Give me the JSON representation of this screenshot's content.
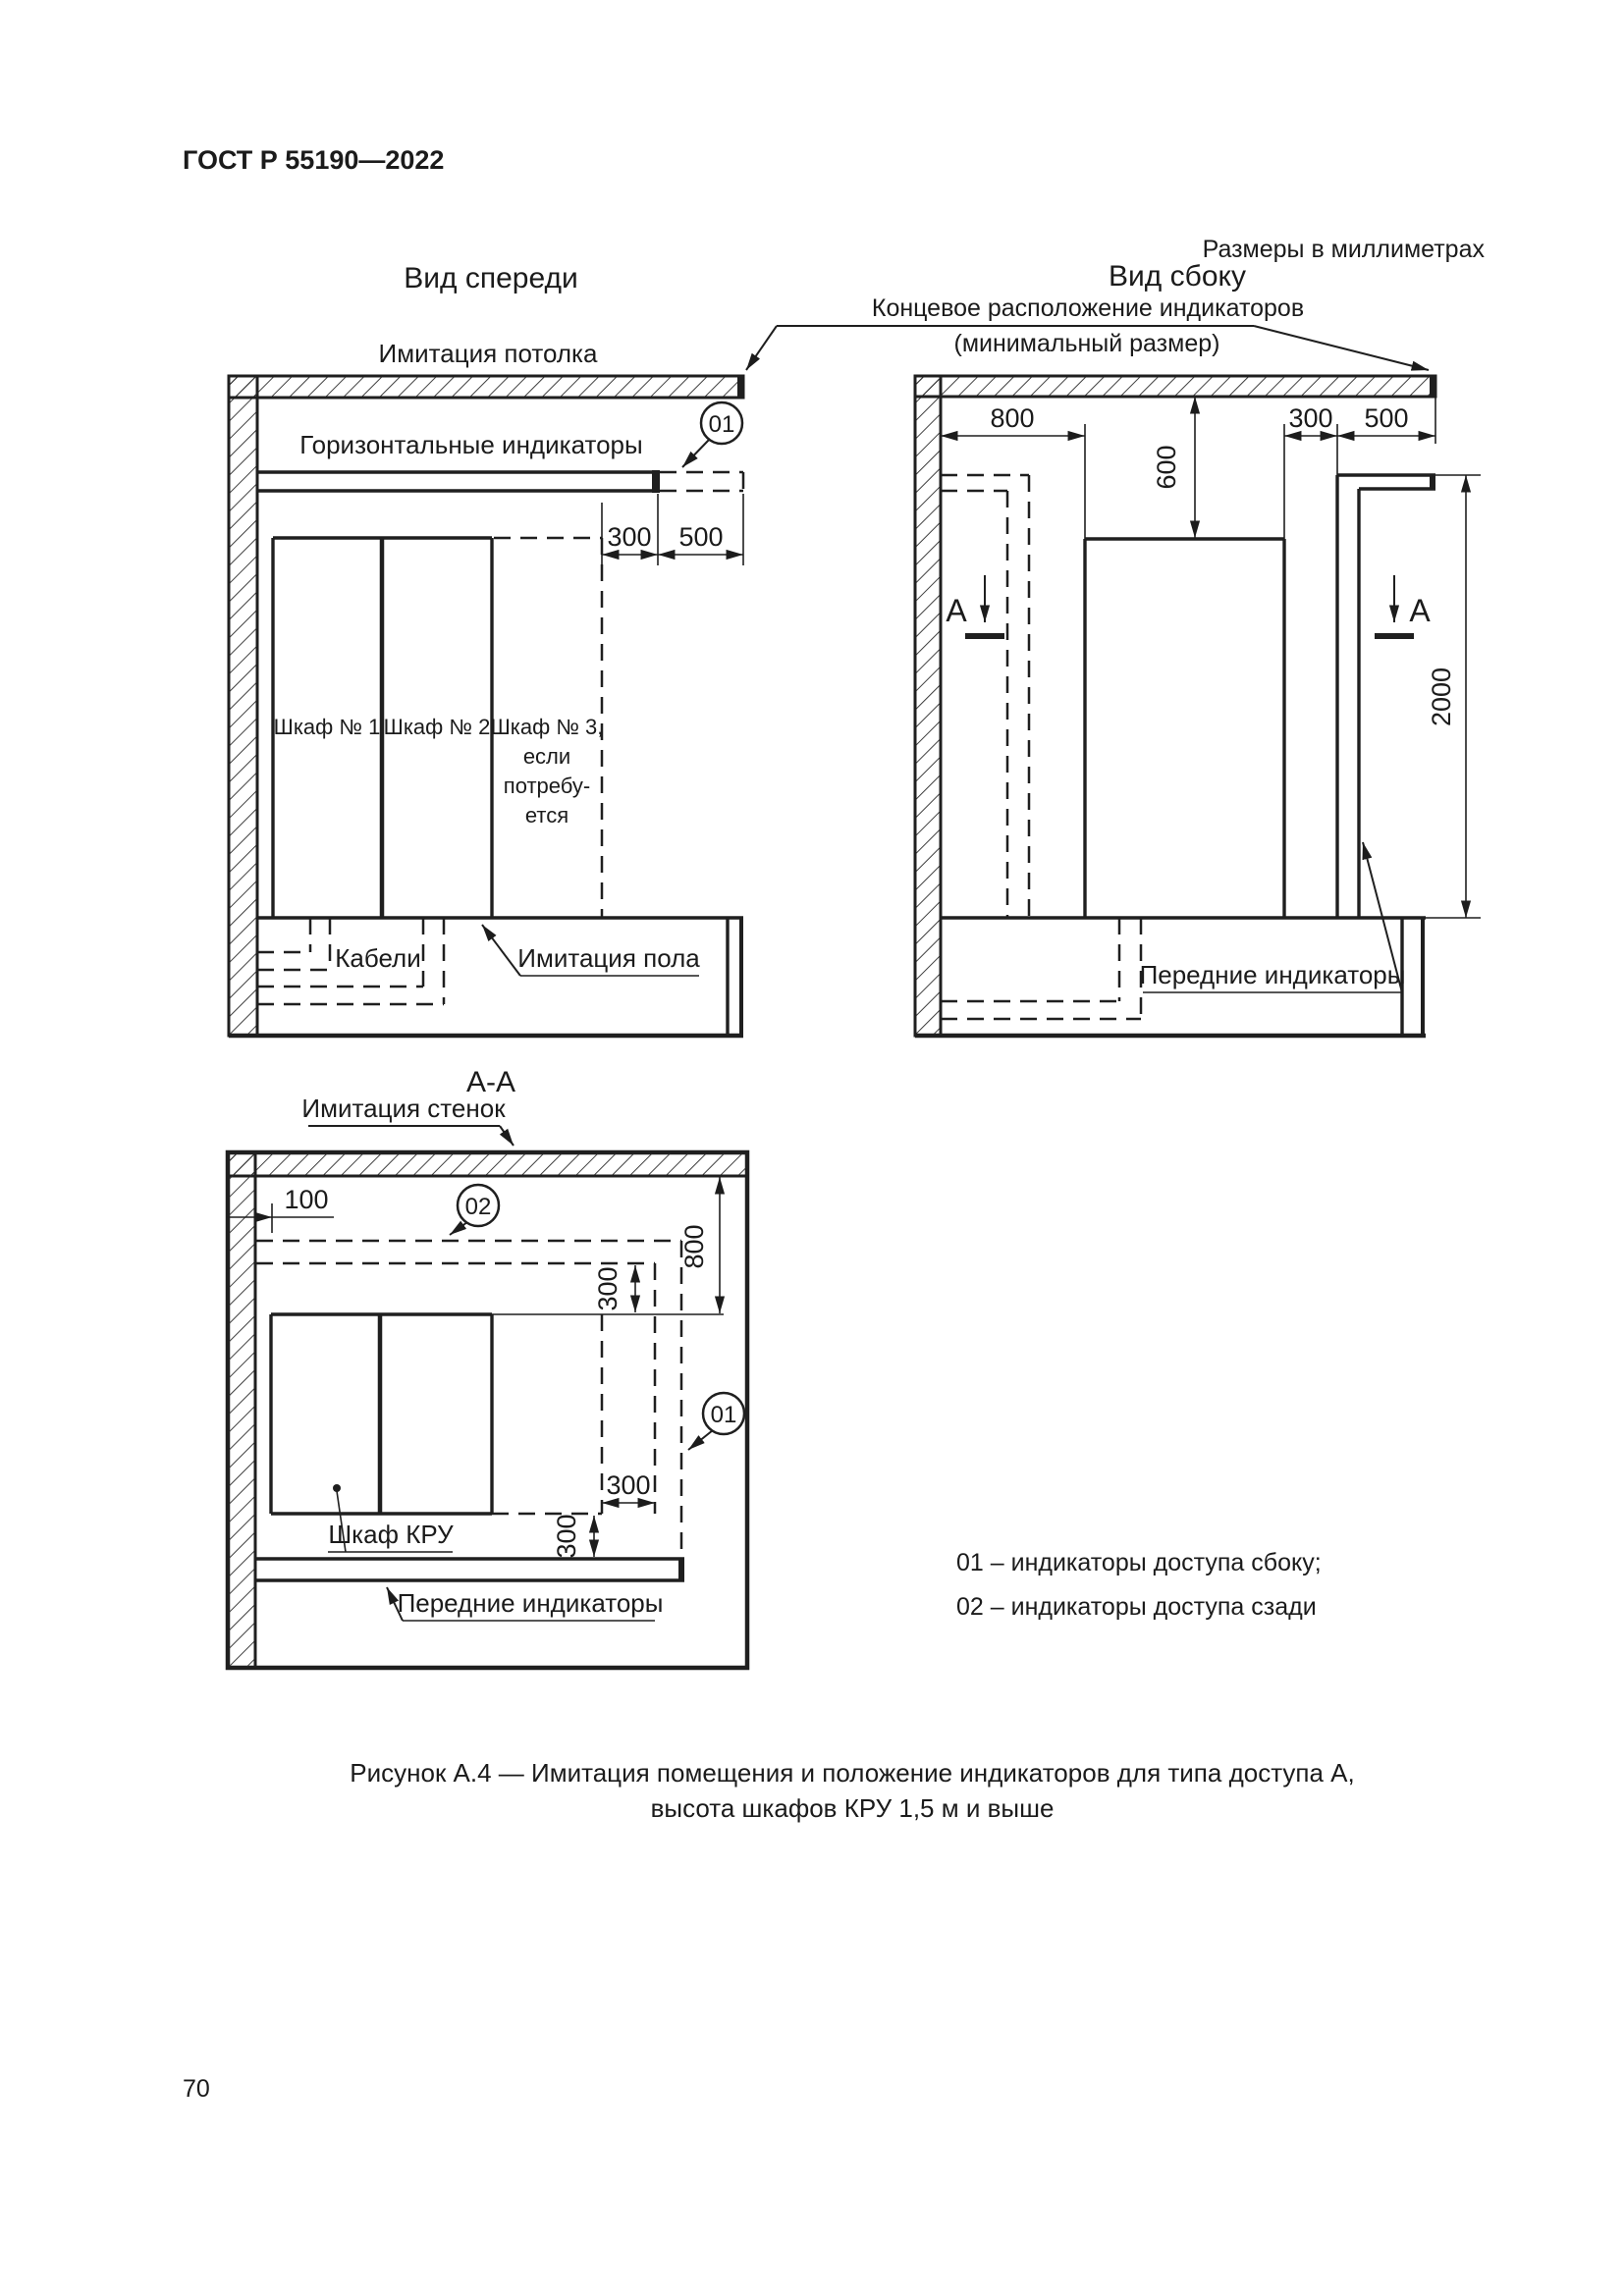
{
  "page": {
    "standard_code": "ГОСТ Р 55190—2022",
    "units_note": "Размеры в миллиметрах",
    "page_number": "70",
    "caption_line1": "Рисунок А.4 — Имитация помещения и положение индикаторов для типа доступа А,",
    "caption_line2": "высота шкафов КРУ 1,5 м и выше"
  },
  "front_view": {
    "title": "Вид спереди",
    "ceiling_label": "Имитация потолка",
    "indicators_label": "Горизонтальные индикаторы",
    "callout_01": "01",
    "dims": {
      "side_gap": "300",
      "end_zone": "500"
    },
    "cabinet_1": "Шкаф № 1",
    "cabinet_2": "Шкаф № 2",
    "cabinet3_lines": [
      "Шкаф № 3,",
      "если",
      "потребу-",
      "ется"
    ],
    "cables_label": "Кабели",
    "floor_label": "Имитация пола"
  },
  "side_view": {
    "title": "Вид сбоку",
    "end_note_line1": "Концевое расположение индикаторов",
    "end_note_line2": "(минимальный размер)",
    "dims": {
      "rear_gap": "800",
      "ceiling_gap": "600",
      "front_gap": "300",
      "end_zone": "500",
      "height": "2000"
    },
    "section_letter": "А",
    "front_indicators_label": "Передние индикаторы"
  },
  "section_view": {
    "title": "А-А",
    "walls_label": "Имитация стенок",
    "callout_02": "02",
    "callout_01": "01",
    "dims": {
      "wall_gap": "100",
      "rear_zone": "800",
      "rear_gap": "300",
      "side_gap": "300",
      "front_gap": "300"
    },
    "cabinet_label": "Шкаф КРУ",
    "front_indicators_label": "Передние индикаторы"
  },
  "legend": {
    "line1": "01 – индикаторы доступа сбоку;",
    "line2": "02 – индикаторы доступа сзади"
  }
}
